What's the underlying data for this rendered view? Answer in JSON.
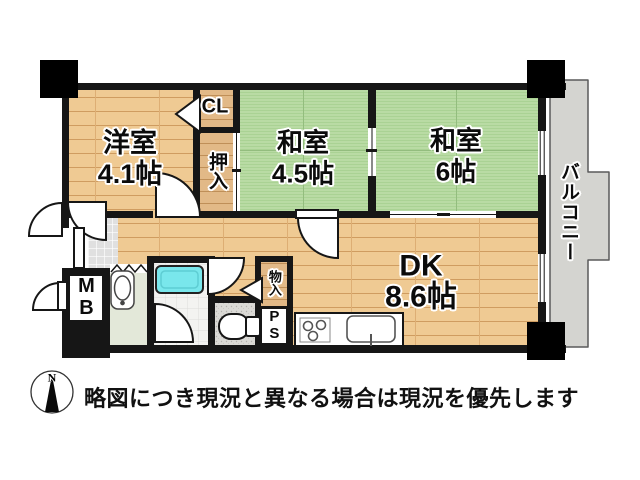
{
  "rooms": {
    "western": {
      "name": "洋室",
      "size": "4.1帖"
    },
    "japanese_45": {
      "name": "和室",
      "size": "4.5帖"
    },
    "japanese_6": {
      "name": "和室",
      "size": "6帖"
    },
    "dining_kitchen": {
      "name": "DK",
      "size": "8.6帖"
    },
    "balcony": {
      "name": "バルコニー"
    },
    "closet": {
      "name": "CL"
    },
    "oshiire": {
      "name": "押入"
    },
    "storage": {
      "name": "物入"
    },
    "pipe_space": {
      "name": "PS"
    },
    "meter_box": {
      "name": "MB"
    }
  },
  "footer": {
    "compass_north": "N",
    "disclaimer": "略図につき現況と異なる場合は現況を優先します"
  },
  "colors": {
    "wall": "#161616",
    "wood_floor": "#efca93",
    "wood_dark": "#e2b987",
    "tatami": "#b8daa3",
    "balcony": "#d4d4d0",
    "bathtub": "#79e7ec",
    "entry_tile": "#e0e0e0",
    "washroom": "#e3e8d9"
  }
}
